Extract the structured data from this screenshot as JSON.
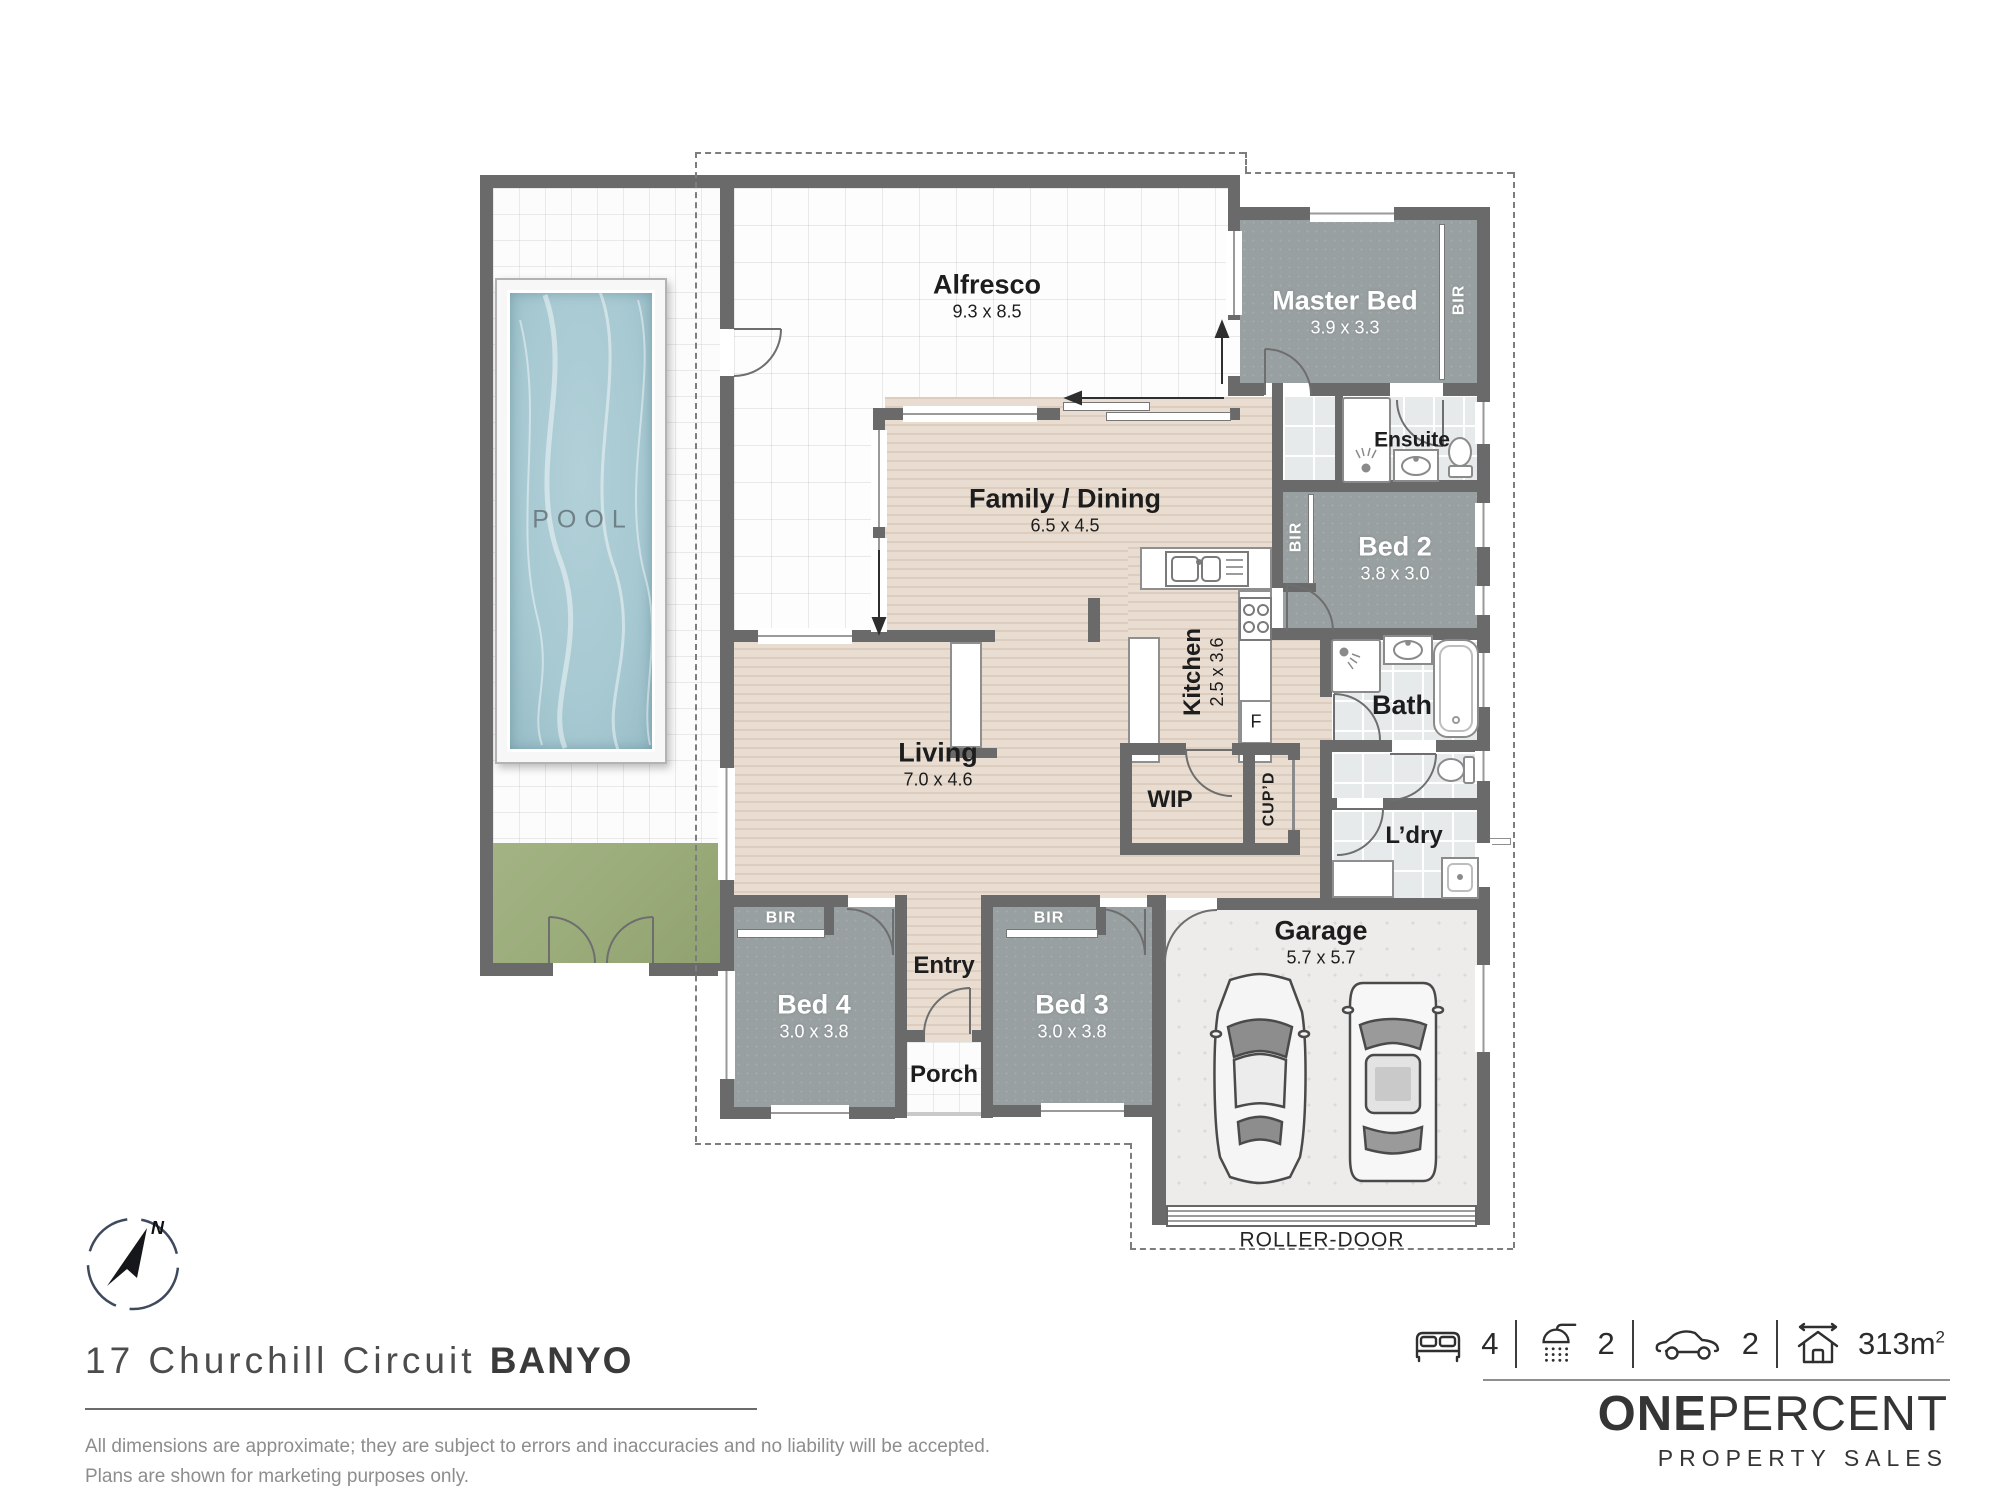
{
  "plan": {
    "rooms": [
      {
        "name": "Alfresco",
        "dims": "9.3 x 8.5"
      },
      {
        "name": "Family / Dining",
        "dims": "6.5 x 4.5"
      },
      {
        "name": "Living",
        "dims": "7.0 x 4.6"
      },
      {
        "name": "Kitchen",
        "dims": "2.5 x 3.6"
      },
      {
        "name": "WIP",
        "dims": ""
      },
      {
        "name": "Master Bed",
        "dims": "3.9 x 3.3"
      },
      {
        "name": "Ensuite",
        "dims": ""
      },
      {
        "name": "Bed 2",
        "dims": "3.8 x 3.0"
      },
      {
        "name": "Bath",
        "dims": ""
      },
      {
        "name": "L’dry",
        "dims": ""
      },
      {
        "name": "Garage",
        "dims": "5.7 x 5.7"
      },
      {
        "name": "Bed 3",
        "dims": "3.0 x 3.8"
      },
      {
        "name": "Bed 4",
        "dims": "3.0 x 3.8"
      },
      {
        "name": "Entry",
        "dims": ""
      },
      {
        "name": "Porch",
        "dims": ""
      }
    ],
    "labels": {
      "pool": "POOL",
      "bir": "BIR",
      "cupboard": "CUP’D",
      "fridge": "F",
      "roller_door": "ROLLER-DOOR"
    }
  },
  "compass": {
    "north": "N"
  },
  "address": {
    "street": "17 Churchill Circuit",
    "suburb": "BANYO"
  },
  "features": {
    "beds": "4",
    "showers": "2",
    "cars": "2",
    "area": "313m",
    "area_exp": "2"
  },
  "brand": {
    "bold": "ONE",
    "light": "PERCENT",
    "tagline": "PROPERTY SALES"
  },
  "disclaimer": {
    "line1": "All dimensions are approximate; they are subject to errors and inaccuracies and no liability will be accepted.",
    "line2": "Plans are shown for marketing purposes only."
  },
  "colors": {
    "wall": "#6a6a6a",
    "water": "#a7c9d2",
    "carpet": "#99a0a1",
    "wood": "#e9ddd2",
    "grass": "#9cad7c",
    "concrete": "#edecea",
    "boundary": "#7d7d7d",
    "ink": "#1d1d1d",
    "brand_ink": "#353535"
  }
}
